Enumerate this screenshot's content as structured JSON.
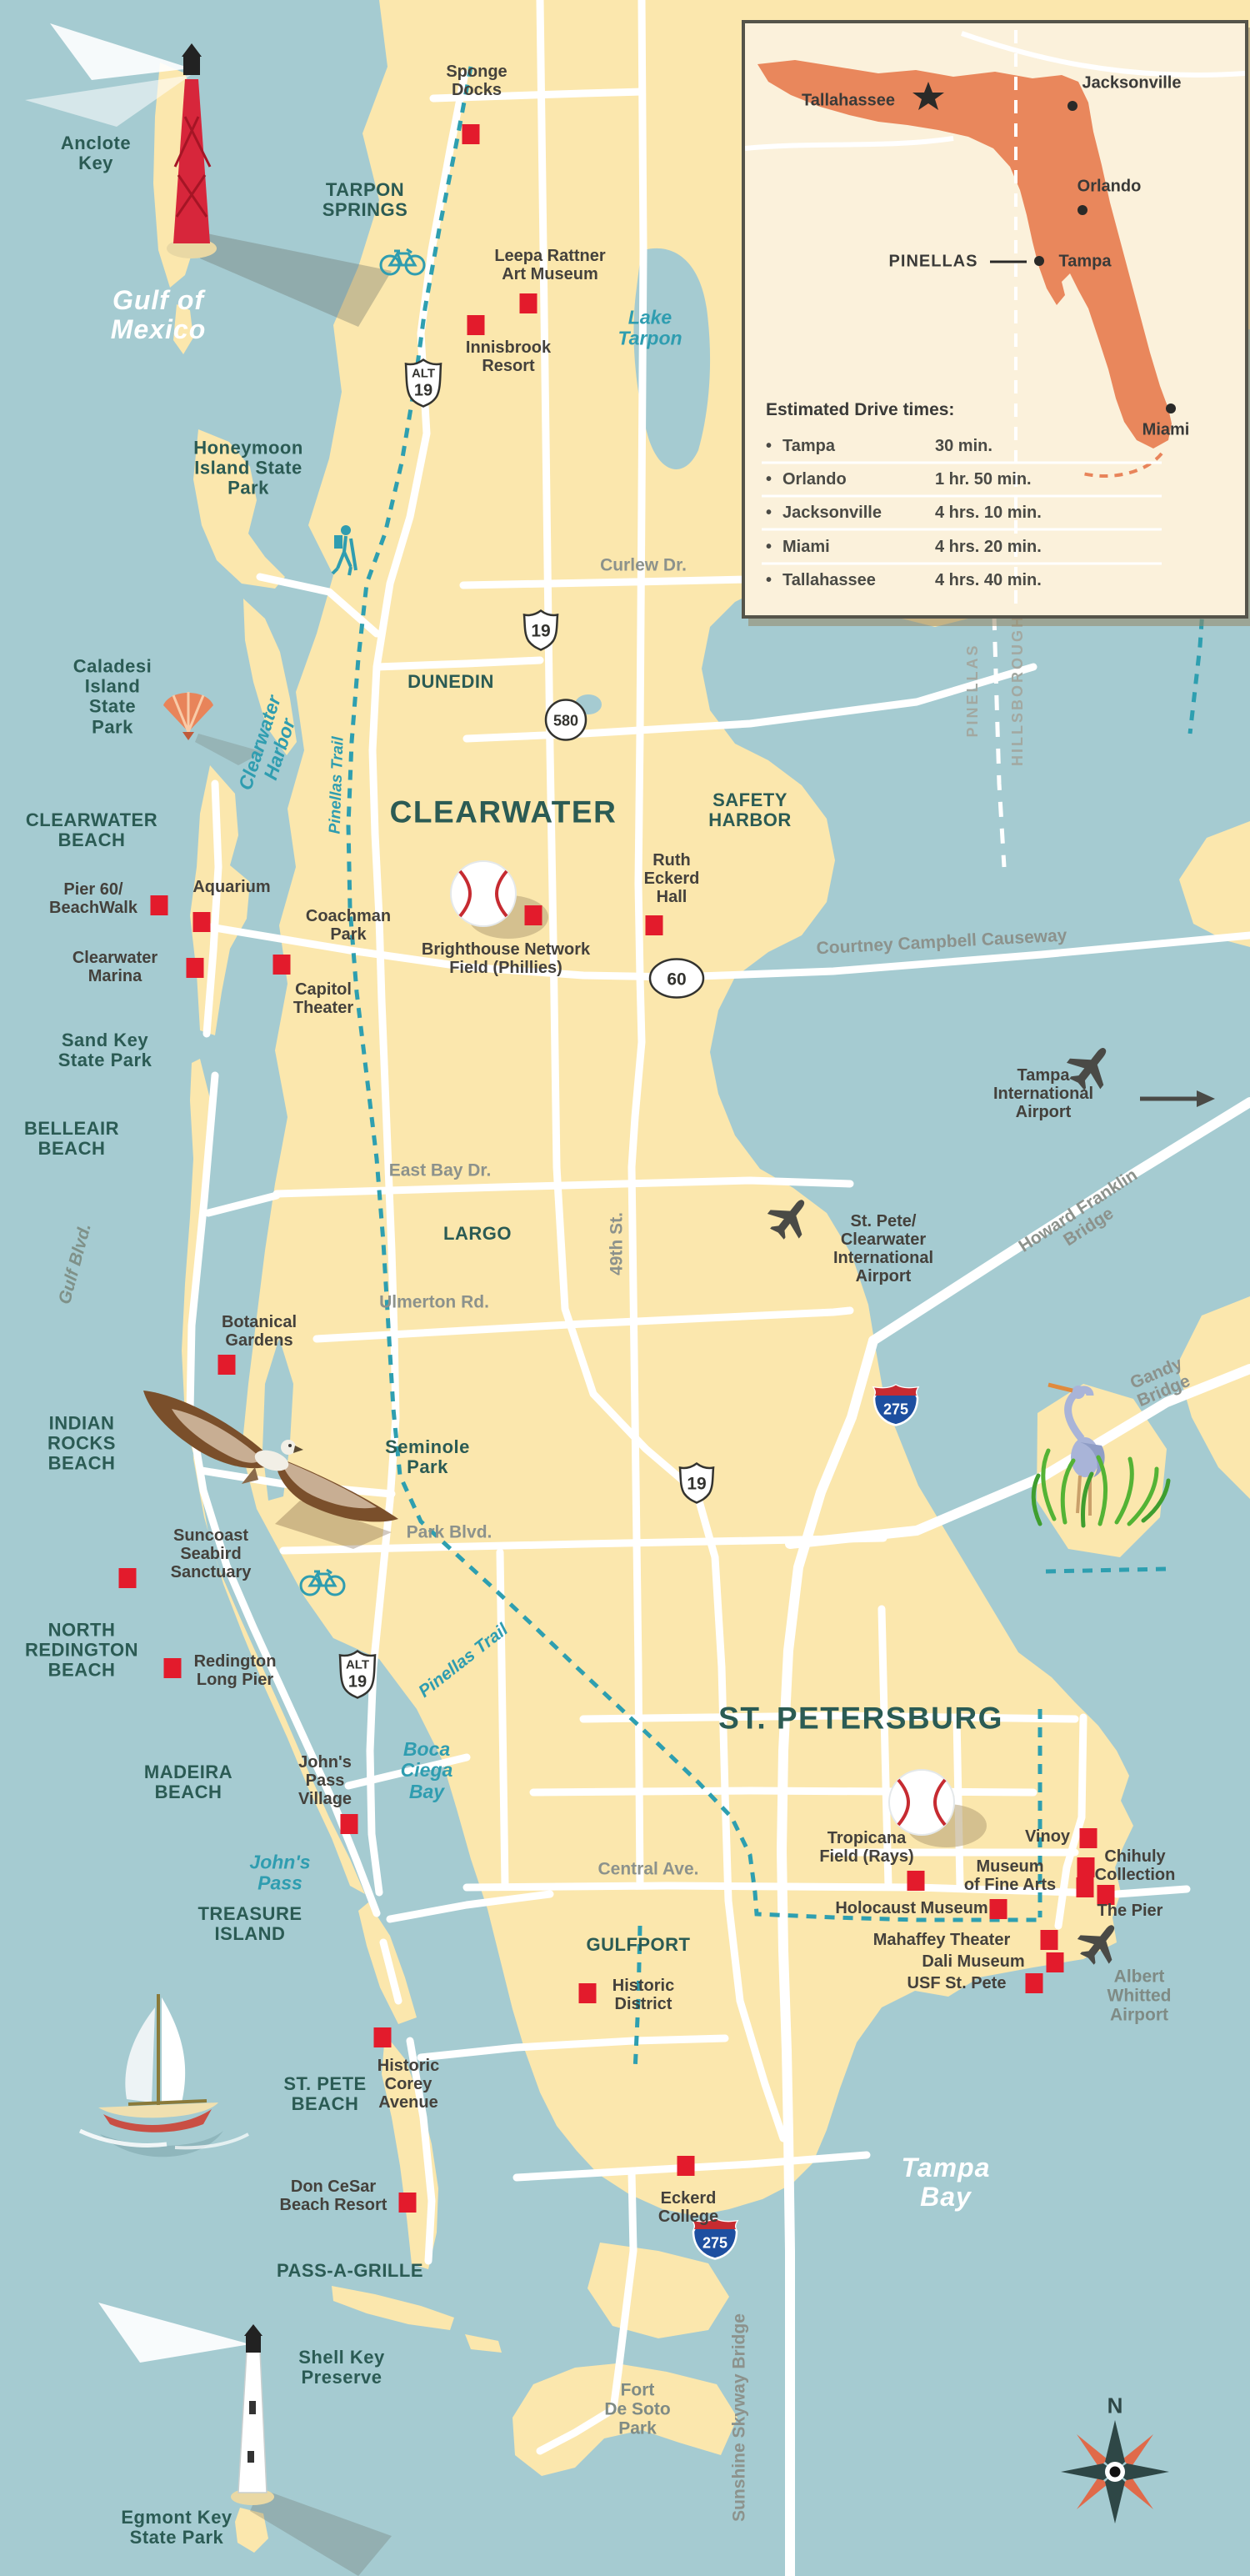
{
  "colors": {
    "water": "#A5CBD1",
    "land": "#FBE7AD",
    "road": "#FFFFFF",
    "trail": "#2E9FB0",
    "marker": "#E31B2C",
    "city_label": "#2B5B54",
    "poi_label": "#44413C",
    "road_label": "#8C928C",
    "water_label": "#2F9DB0",
    "inset_bg": "#FBF1DB",
    "florida": "#E9875C",
    "interstate_blue": "#1D4FA0",
    "interstate_red": "#C62B31"
  },
  "shields": {
    "us19": "19",
    "alt": "ALT",
    "sr580": "580",
    "sr60": "60",
    "i275": "275"
  },
  "compass": {
    "north": "N"
  },
  "labels": {
    "anclote_key": "Anclote\nKey",
    "gulf_of_mexico": "Gulf of\nMexico",
    "tarpon_springs": "TARPON\nSPRINGS",
    "sponge_docks": "Sponge\nDocks",
    "leepa_rattner": "Leepa Rattner\nArt Museum",
    "innisbrook": "Innisbrook\nResort",
    "lake_tarpon": "Lake\nTarpon",
    "honeymoon": "Honeymoon\nIsland State\nPark",
    "curlew": "Curlew Dr.",
    "caladesi": "Caladesi\nIsland\nState\nPark",
    "clearwater_harbor": "Clearwater\nHarbor",
    "pinellas_trail_1": "Pinellas Trail",
    "dunedin": "DUNEDIN",
    "clearwater": "CLEARWATER",
    "safety_harbor": "SAFETY\nHARBOR",
    "ruth_eckerd": "Ruth\nEckerd\nHall",
    "clearwater_beach": "CLEARWATER\nBEACH",
    "pier60": "Pier 60/\nBeachWalk",
    "aquarium": "Aquarium",
    "coachman": "Coachman\nPark",
    "clearwater_marina": "Clearwater\nMarina",
    "capitol_theater": "Capitol\nTheater",
    "brighthouse": "Brighthouse Network\nField (Phillies)",
    "courtney": "Courtney Campbell Causeway",
    "pinellas_county": "PINELLAS",
    "hillsborough_county": "HILLSBOROUGH",
    "tampa_intl": "Tampa\nInternational\nAirport",
    "sand_key": "Sand Key\nState Park",
    "belleair": "BELLEAIR\nBEACH",
    "gulf_blvd": "Gulf Blvd.",
    "east_bay": "East Bay Dr.",
    "largo": "LARGO",
    "st_49th": "49th St.",
    "stpete_cw_airport": "St. Pete/\nClearwater\nInternational\nAirport",
    "howard_franklin": "Howard Franklin Bridge",
    "ulmerton": "Ulmerton Rd.",
    "botanical": "Botanical\nGardens",
    "gandy": "Gandy Bridge",
    "indian_rocks": "INDIAN\nROCKS\nBEACH",
    "seminole_park": "Seminole\nPark",
    "i275_note": "",
    "park_blvd": "Park Blvd.",
    "suncoast": "Suncoast\nSeabird\nSanctuary",
    "pinellas_trail_2": "Pinellas Trail",
    "north_redington": "NORTH\nREDINGTON\nBEACH",
    "redington_pier": "Redington\nLong Pier",
    "alt19_note": "",
    "madeira": "MADEIRA\nBEACH",
    "johns_pass_village": "John's\nPass\nVillage",
    "boca_ciega": "Boca\nCiega\nBay",
    "st_petersburg": "ST. PETERSBURG",
    "johns_pass": "John's\nPass",
    "central_ave": "Central Ave.",
    "tropicana": "Tropicana\nField (Rays)",
    "vinoy": "Vinoy",
    "chihuly": "Chihuly\nCollection",
    "mofa": "Museum\nof Fine Arts",
    "the_pier": "The Pier",
    "holocaust": "Holocaust Museum",
    "mahaffey": "Mahaffey Theater",
    "dali": "Dali Museum",
    "usf": "USF St. Pete",
    "albert_whitted": "Albert\nWhitted\nAirport",
    "gulfport": "GULFPORT",
    "historic_district": "Historic\nDistrict",
    "treasure_island": "TREASURE\nISLAND",
    "st_pete_beach": "ST. PETE\nBEACH",
    "historic_corey": "Historic\nCorey\nAvenue",
    "don_cesar": "Don CeSar\nBeach Resort",
    "pass_a_grille": "PASS-A-GRILLE",
    "shell_key": "Shell Key\nPreserve",
    "fort_desoto": "Fort\nDe Soto\nPark",
    "egmont": "Egmont Key\nState Park",
    "eckerd": "Eckerd\nCollege",
    "sunshine_skyway": "Sunshine Skyway Bridge",
    "tampa_bay": "Tampa\nBay"
  },
  "inset": {
    "cities": {
      "tallahassee": "Tallahassee",
      "jacksonville": "Jacksonville",
      "orlando": "Orlando",
      "tampa": "Tampa",
      "miami": "Miami"
    },
    "county_callout": "PINELLAS",
    "drive_times": {
      "title": "Estimated Drive times:",
      "bullet": "•",
      "rows": [
        {
          "destination": "Tampa",
          "time": "30 min."
        },
        {
          "destination": "Orlando",
          "time": "1 hr. 50 min."
        },
        {
          "destination": "Jacksonville",
          "time": "4 hrs. 10 min."
        },
        {
          "destination": "Miami",
          "time": "4 hrs. 20 min."
        },
        {
          "destination": "Tallahassee",
          "time": "4 hrs. 40 min."
        }
      ]
    }
  }
}
